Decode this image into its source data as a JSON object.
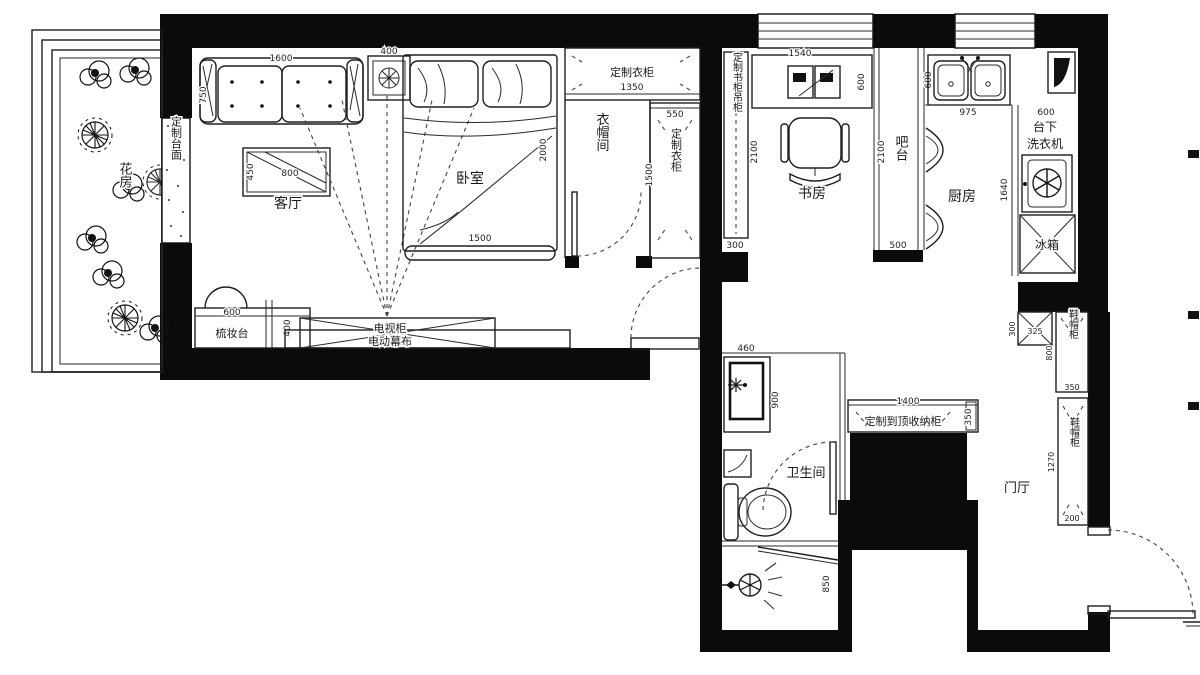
{
  "rooms": {
    "flower_room": "花房",
    "living_room": "客厅",
    "bedroom": "卧室",
    "cloakroom": "衣帽间",
    "study": "书房",
    "bar": "吧台",
    "kitchen": "厨房",
    "bathroom": "卫生间",
    "foyer": "门厅"
  },
  "fixtures": {
    "custom_counter": "定制台面",
    "wardrobe_top": "定制衣柜",
    "wardrobe_side": "定制衣柜",
    "bookcase_hang": "定制书柜吊柜",
    "dresser": "梳妆台",
    "tv_cabinet": "电视柜",
    "motor_screen": "电动幕布",
    "washer_line1": "台下",
    "washer_line2": "洗衣机",
    "fridge": "冰箱",
    "storage_cabinet": "定制到顶收纳柜",
    "shoe_cabinet_a": "鞋帽柜",
    "shoe_cabinet_b": "鞋帽柜"
  },
  "dims": {
    "sofa_w": "1600",
    "sofa_d": "750",
    "table_w": "800",
    "table_d": "450",
    "nightstand": "400",
    "bed_w": "1500",
    "bed_l": "2000",
    "wardrobe_top_w": "1350",
    "wardrobe_side_w": "550",
    "wardrobe_side_h": "1500",
    "bookcase_d": "300",
    "desk_w": "1540",
    "desk_d": "600",
    "study_l": "2100",
    "bar_l": "2100",
    "bar_end": "500",
    "counter_d": "600",
    "sink_w": "975",
    "washer_w": "600",
    "washer_col_l": "1640",
    "vanity_w": "460",
    "vanity_l": "900",
    "shower_l": "850",
    "storage_w": "1400",
    "storage_d": "350",
    "shoe_small_w": "325",
    "shoe_small_d": "300",
    "shoe_a_l": "800",
    "shoe_a_w": "350",
    "shoe_b_l": "1270",
    "shoe_b_end": "200",
    "dresser_w": "600",
    "dresser_d": "400"
  }
}
